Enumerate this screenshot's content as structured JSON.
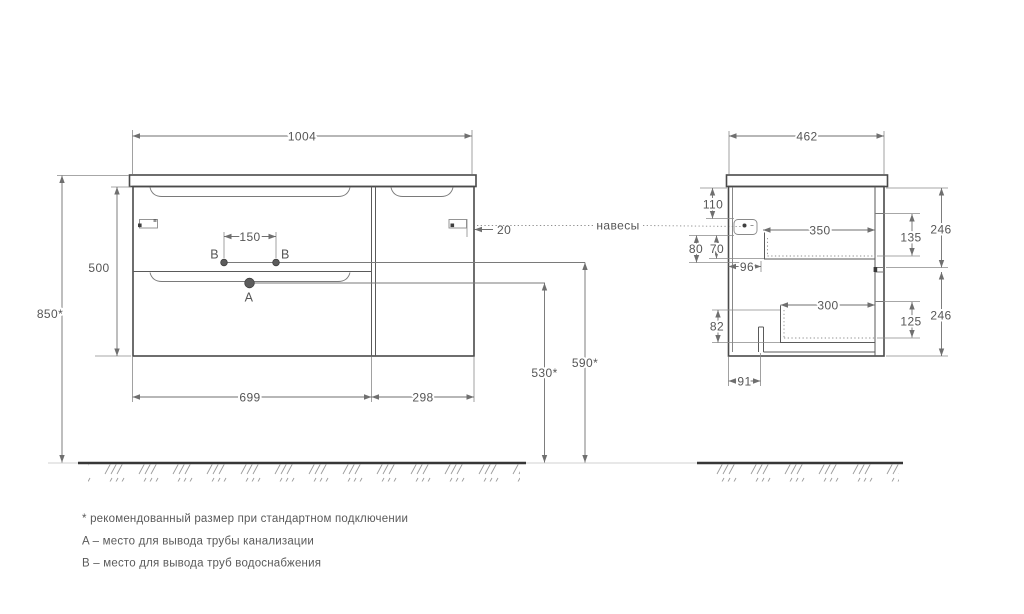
{
  "front": {
    "width_top": "1004",
    "cabinet_height": "500",
    "total_height": "850*",
    "faucet_spacing": "150",
    "hanger_offset": "20",
    "drawers_width": "699",
    "door_width": "298",
    "drain_height": "530*",
    "water_height": "590*",
    "point_a": "A",
    "point_b": "B"
  },
  "side": {
    "depth": "462",
    "hanger_top_offset": "110",
    "hanger_height_outer": "80",
    "hanger_height_inner": "70",
    "hanger_depth": "96",
    "top_drawer_depth": "350",
    "top_drawer_inner_height": "135",
    "top_front_height": "246",
    "bottom_drawer_depth": "300",
    "bottom_drawer_inner_height": "125",
    "bottom_front_height": "246",
    "bottom_clearance": "82",
    "notch_depth": "91"
  },
  "hangers_label": "навесы",
  "notes": {
    "recommended": "* рекомендованный размер при стандартном подключении",
    "point_a": "A – место для вывода трубы канализации",
    "point_b": "B – место для вывода труб водоснабжения"
  },
  "colors": {
    "background": "#ffffff",
    "outline": "#4a4a4a",
    "dimension": "#6f6f6f",
    "text": "#565656",
    "hatch": "#9b9b9b"
  }
}
